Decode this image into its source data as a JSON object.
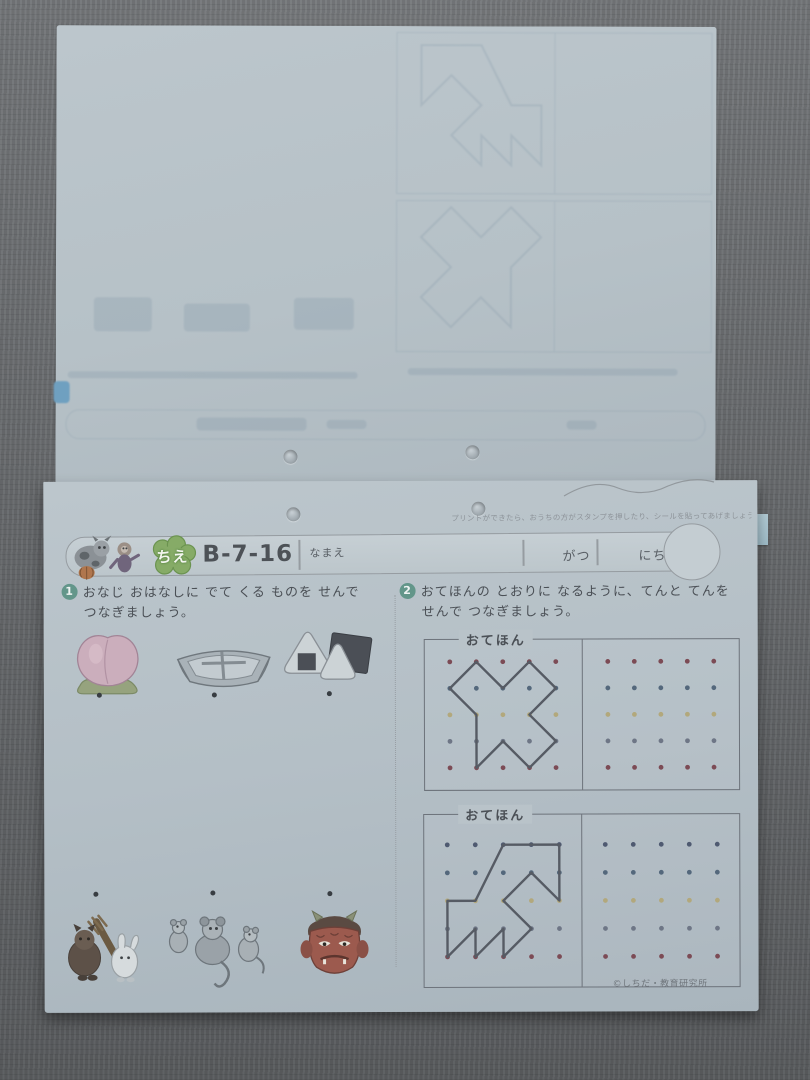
{
  "header": {
    "badge": "ちえ",
    "code": "B-7-16",
    "name_label": "なまえ",
    "month_label": "がつ",
    "day_label": "にち"
  },
  "top_note": "プリントができたら、おうちの方がスタンプを押したり、シールを貼ってあげましょう。➡",
  "q1": {
    "number": "1",
    "line1": "おなじ おはなしに でて くる ものを せんで",
    "line2": "つなぎましょう。",
    "top_items": [
      "peach",
      "boat",
      "rice-balls"
    ],
    "bottom_items": [
      "tanuki-and-rabbit",
      "mice",
      "oni-mask"
    ]
  },
  "q2": {
    "number": "2",
    "line1": "おてほんの とおりに なるように、てんと てんを",
    "line2": "せんで つなぎましょう。",
    "boxes": [
      {
        "label": "おてほん",
        "grid": {
          "cols": 5,
          "rows": 5,
          "spacing": 26.5
        },
        "row_colors": [
          "#7c4b55",
          "#54687c",
          "#b2a87c",
          "#6e7686",
          "#7c4b55"
        ],
        "shape": [
          [
            1,
            0
          ],
          [
            0,
            1
          ],
          [
            1,
            2
          ],
          [
            1,
            4
          ],
          [
            2,
            3
          ],
          [
            3,
            4
          ],
          [
            4,
            3
          ],
          [
            3,
            2
          ],
          [
            4,
            1
          ],
          [
            3,
            0
          ],
          [
            2,
            1
          ]
        ]
      },
      {
        "label": "おてほん",
        "grid": {
          "cols": 5,
          "rows": 5,
          "spacing": 28
        },
        "row_colors": [
          "#4f5a71",
          "#54687c",
          "#b2a87c",
          "#6e7686",
          "#7c4b55"
        ],
        "shape": [
          [
            2,
            0
          ],
          [
            4,
            0
          ],
          [
            4,
            2
          ],
          [
            3,
            1
          ],
          [
            2,
            2
          ],
          [
            3,
            3
          ],
          [
            2,
            4
          ],
          [
            2,
            3
          ],
          [
            1,
            4
          ],
          [
            1,
            3
          ],
          [
            0,
            4
          ],
          [
            0,
            2
          ],
          [
            1,
            2
          ]
        ]
      }
    ]
  },
  "copyright": "©しちだ・教育研究所",
  "colors": {
    "paper": "#b6c1c7",
    "mat": "#6b6e71",
    "accent_green": "#7fa86a",
    "dot_black": "#383d42",
    "shape_line": "#565b64"
  }
}
